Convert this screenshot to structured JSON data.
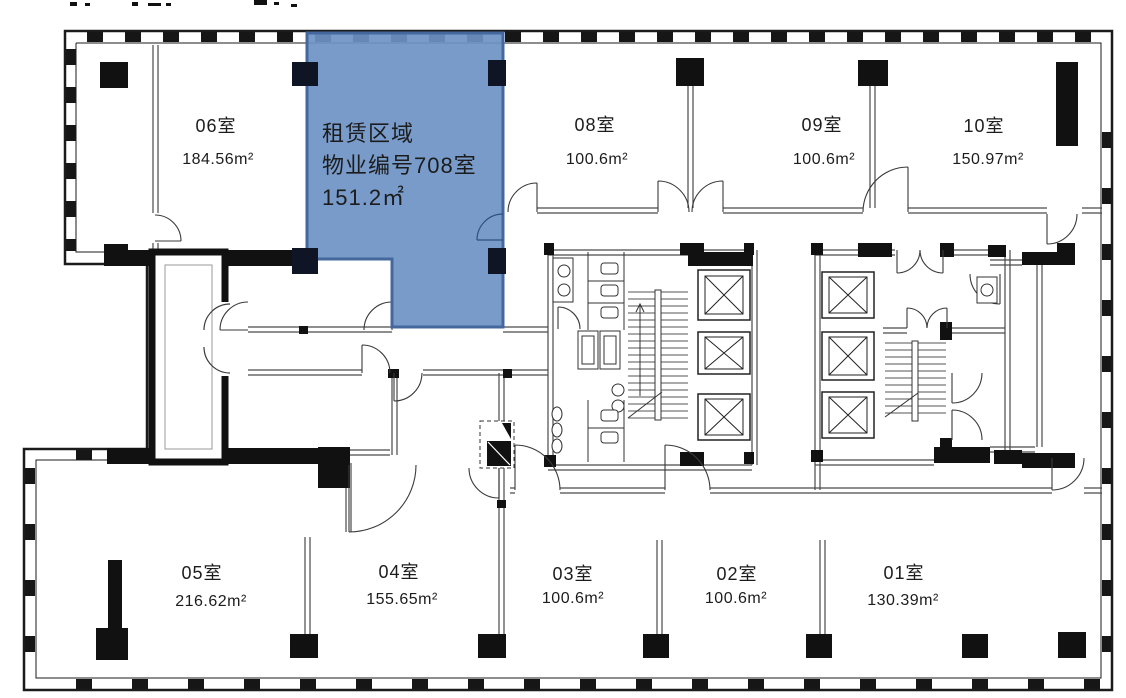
{
  "canvas": {
    "width": 1126,
    "height": 698,
    "background": "#ffffff"
  },
  "highlight": {
    "line1": "租赁区域",
    "line2": "物业编号708室",
    "line3": "151.2㎡",
    "fill": "#6C92C6",
    "border": "#44689E",
    "text_color": "#1d2433"
  },
  "rooms": [
    {
      "id": "06",
      "name": "06室",
      "area": "184.56m²"
    },
    {
      "id": "08",
      "name": "08室",
      "area": "100.6m²"
    },
    {
      "id": "09",
      "name": "09室",
      "area": "100.6m²"
    },
    {
      "id": "10",
      "name": "10室",
      "area": "150.97m²"
    },
    {
      "id": "05",
      "name": "05室",
      "area": "216.62m²"
    },
    {
      "id": "04",
      "name": "04室",
      "area": "155.65m²"
    },
    {
      "id": "03",
      "name": "03室",
      "area": "100.6m²"
    },
    {
      "id": "02",
      "name": "02室",
      "area": "100.6m²"
    },
    {
      "id": "01",
      "name": "01室",
      "area": "130.39m²"
    }
  ]
}
